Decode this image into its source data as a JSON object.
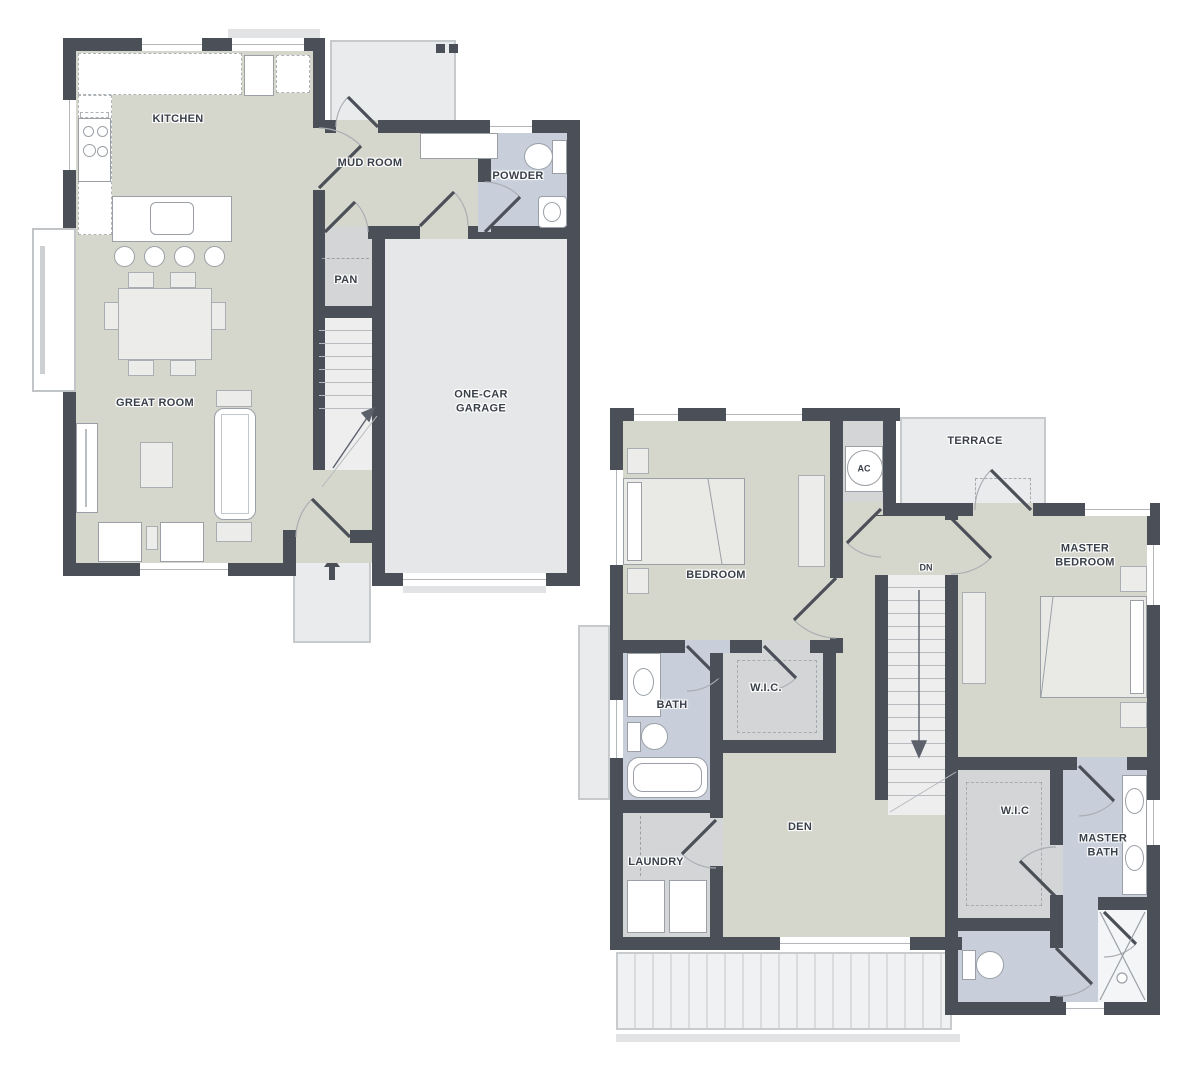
{
  "palette": {
    "wall": "#4b4f58",
    "floor": "#d5d6cc",
    "floorGray": "#e6e7e8",
    "closet": "#d4d5d7",
    "bath": "#c8cfdb",
    "stairsFloor": "#eeeeef",
    "showerFloor": "#f4f5f6",
    "outside": "#eaebec",
    "line": "#9aa0a6",
    "windowLine": "#b3b7bb",
    "deckStripe": "#d9dbdd",
    "ink": "#3a404a"
  },
  "floor1": {
    "labels": {
      "kitchen": "KITCHEN",
      "mud_room": "MUD ROOM",
      "powder": "POWDER",
      "pantry": "PAN",
      "great_room": "GREAT ROOM",
      "garage": "ONE-CAR GARAGE"
    }
  },
  "floor2": {
    "labels": {
      "bedroom": "BEDROOM",
      "ac": "AC",
      "terrace": "TERRACE",
      "stairs_down": "DN",
      "master_bedroom": "MASTER BEDROOM",
      "bath": "BATH",
      "wic": "W.I.C.",
      "den": "DEN",
      "laundry": "LAUNDRY",
      "master_wic": "W.I.C",
      "master_bath": "MASTER BATH"
    }
  }
}
